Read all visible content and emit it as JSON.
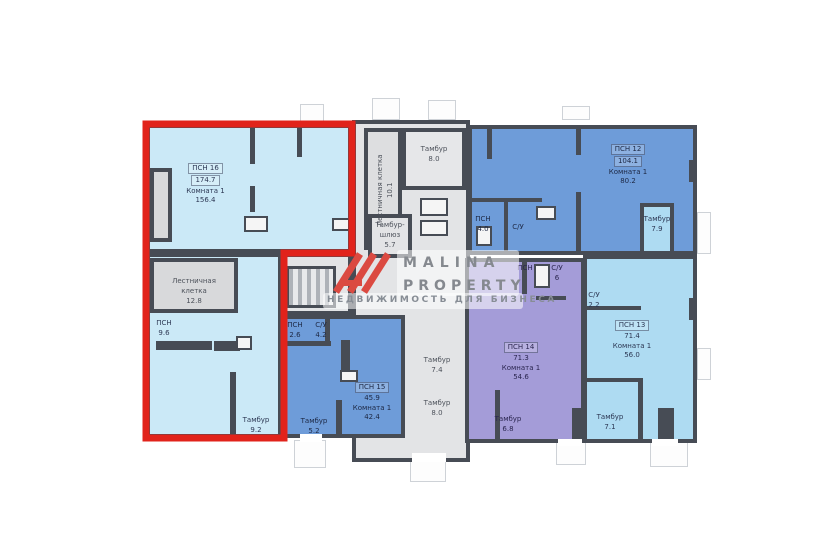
{
  "watermark": {
    "brand_line1": "MALINA",
    "brand_line2": "PROPERTY",
    "tagline": "НЕДВИЖИМОСТЬ ДЛЯ БИЗНЕСА",
    "logo_color": "#db4a41",
    "text_color": "#85898f"
  },
  "colors": {
    "highlight_red": "#e1231b",
    "wall": "#474c55",
    "unit_pale_blue": "#cbe9f7",
    "unit_medium_blue": "#6e9cd9",
    "unit_light_blue": "#aedbf2",
    "unit_purple": "#a49cd8",
    "core_gray": "#e3e4e6"
  },
  "rooms": {
    "psn16": {
      "name": "ПСН 16",
      "area": "174.7",
      "sub": "Комната 1",
      "sub_area": "156.4"
    },
    "stair_left": {
      "l1": "Лестничная",
      "l2": "клетка",
      "area": "12.8"
    },
    "psn_96": {
      "name": "ПСН",
      "area": "9.6"
    },
    "tambur_92": {
      "name": "Тамбур",
      "area": "9.2"
    },
    "stair_core": {
      "l1": "Лестничная клетка",
      "area": "10.1"
    },
    "tambur_80a": {
      "name": "Тамбур",
      "area": "8.0"
    },
    "tambur_shluz": {
      "l1": "Тамбур-",
      "l2": "шлюз",
      "area": "5.7"
    },
    "tambur_74": {
      "name": "Тамбур",
      "area": "7.4"
    },
    "tambur_80b": {
      "name": "Тамбур",
      "area": "8.0"
    },
    "psn12": {
      "name": "ПСН 12",
      "area": "104.1",
      "sub": "Комната 1",
      "sub_area": "80.2"
    },
    "psn_40": {
      "name": "ПСН",
      "area": "4.0"
    },
    "su_a": {
      "name": "С/У"
    },
    "tambur_79": {
      "name": "Тамбур",
      "area": "7.9"
    },
    "psn15": {
      "name": "ПСН 15",
      "area": "45.9",
      "sub": "Комната 1",
      "sub_area": "42.4"
    },
    "psn_26": {
      "name": "ПСН",
      "area": "2.6"
    },
    "su_42": {
      "name": "С/У",
      "area": "4.2"
    },
    "tambur_52": {
      "name": "Тамбур",
      "area": "5.2"
    },
    "psn14": {
      "name": "ПСН 14",
      "area": "71.3",
      "sub": "Комната 1",
      "sub_area": "54.6"
    },
    "psn_p": {
      "name": "ПСН"
    },
    "su_6": {
      "name": "С/У",
      "area": "6"
    },
    "tambur_68": {
      "name": "Тамбур",
      "area": "6.8"
    },
    "psn13": {
      "name": "ПСН 13",
      "area": "71.4",
      "sub": "Комната 1",
      "sub_area": "56.0"
    },
    "su_22": {
      "name": "С/У",
      "area": "2.2"
    },
    "tambur_71": {
      "name": "Тамбур",
      "area": "7.1"
    }
  }
}
